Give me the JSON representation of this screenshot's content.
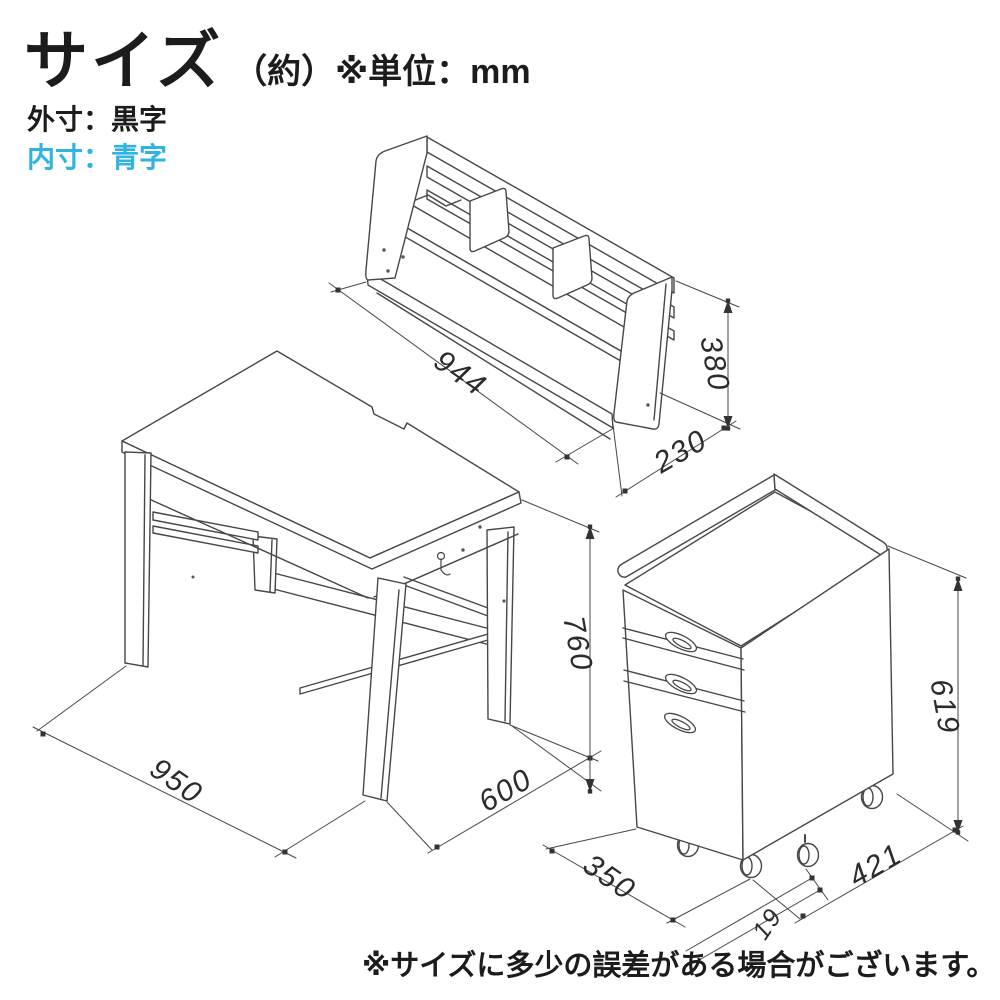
{
  "header": {
    "title": "サイズ",
    "title_note": "（約）※単位：mm"
  },
  "legend": {
    "outer_label": "外寸：黒字",
    "inner_label": "内寸：青字",
    "outer_color": "#1c1c1c",
    "inner_color": "#2fb3e3"
  },
  "unit": "mm",
  "items": [
    {
      "id": "hutch",
      "label": "desk shelf hutch",
      "dimensions": {
        "width": "944",
        "height": "380",
        "depth": "230"
      }
    },
    {
      "id": "desk",
      "label": "desk",
      "dimensions": {
        "width": "950",
        "height": "760",
        "depth": "600"
      }
    },
    {
      "id": "wagon",
      "label": "drawer wagon",
      "dimensions": {
        "width": "350",
        "height": "619",
        "depth": "421",
        "caster_offset": "19"
      }
    }
  ],
  "footer": {
    "disclaimer": "※サイズに多少の誤差がある場合がございます。"
  }
}
